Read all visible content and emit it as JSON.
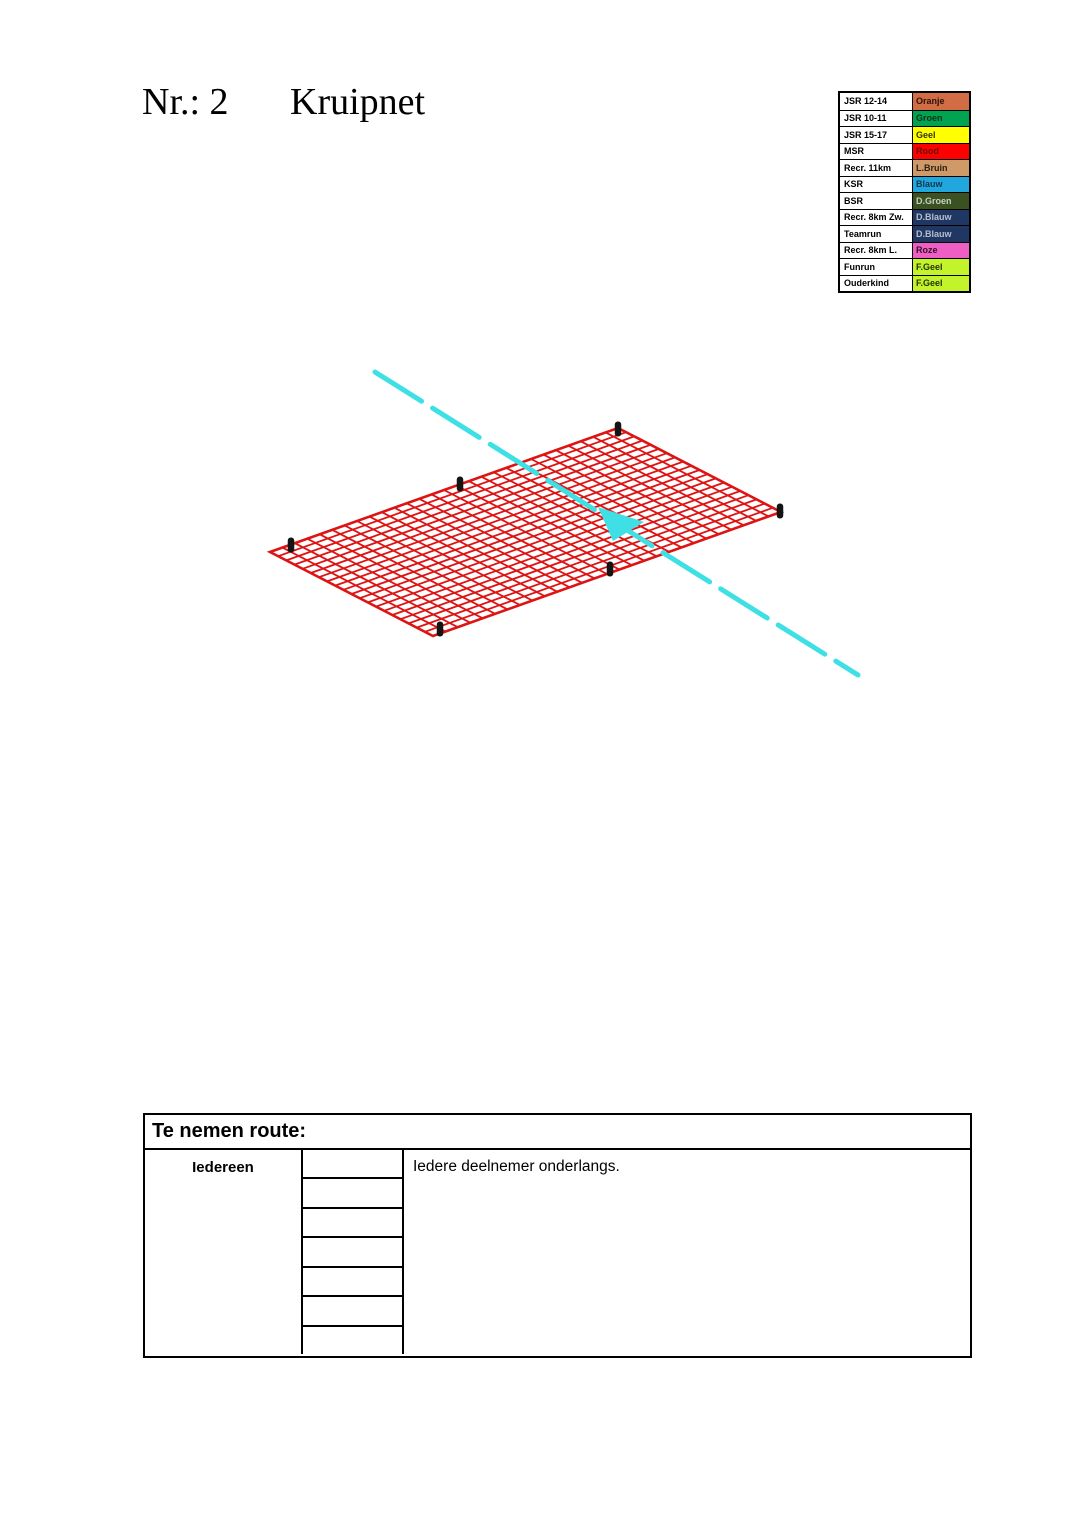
{
  "header": {
    "number_label": "Nr.: 2",
    "title": "Kruipnet"
  },
  "legend": {
    "rows": [
      {
        "label": "JSR 12-14",
        "color_name": "Oranje",
        "bg": "#D16C45",
        "fg": "#2A1209"
      },
      {
        "label": "JSR 10-11",
        "color_name": "Groen",
        "bg": "#00A350",
        "fg": "#13301C"
      },
      {
        "label": "JSR 15-17",
        "color_name": "Geel",
        "bg": "#FFFF00",
        "fg": "#33330A"
      },
      {
        "label": "MSR",
        "color_name": "Rood",
        "bg": "#FF0000",
        "fg": "#6B1007"
      },
      {
        "label": "Recr. 11km",
        "color_name": "L.Bruin",
        "bg": "#CF9A67",
        "fg": "#2E2013"
      },
      {
        "label": "KSR",
        "color_name": "Blauw",
        "bg": "#21A6DE",
        "fg": "#10374D"
      },
      {
        "label": "BSR",
        "color_name": "D.Groen",
        "bg": "#3A5222",
        "fg": "#C9CFC3"
      },
      {
        "label": "Recr. 8km Zw.",
        "color_name": "D.Blauw",
        "bg": "#203764",
        "fg": "#B9BFCA"
      },
      {
        "label": "Teamrun",
        "color_name": "D.Blauw",
        "bg": "#203764",
        "fg": "#B9BFCA"
      },
      {
        "label": "Recr. 8km L.",
        "color_name": "Roze",
        "bg": "#EF5EC2",
        "fg": "#331226"
      },
      {
        "label": "Funrun",
        "color_name": "F.Geel",
        "bg": "#C2F32B",
        "fg": "#28330A"
      },
      {
        "label": "Ouderkind",
        "color_name": "F.Geel",
        "bg": "#C2F32B",
        "fg": "#28330A"
      }
    ]
  },
  "diagram": {
    "description": "kruipnet-crawl-net-isometric",
    "net": {
      "corner_top": [
        618,
        428
      ],
      "corner_right": [
        781,
        512
      ],
      "corner_bottom": [
        433,
        636
      ],
      "corner_left": [
        270,
        552
      ],
      "divisions_long_edge": 28,
      "divisions_short_edge": 20,
      "grid_color": "#DE1313",
      "grid_stroke_width": 1.8,
      "outline_stroke_width": 2.6
    },
    "posts": {
      "color": "#141414",
      "width": 6.5,
      "height": 15,
      "positions": [
        [
          618,
          429
        ],
        [
          460,
          484
        ],
        [
          291,
          545
        ],
        [
          780,
          511
        ],
        [
          610,
          569
        ],
        [
          440,
          629
        ]
      ]
    },
    "arrow": {
      "color": "#3FE0E5",
      "from": [
        375,
        372
      ],
      "to": [
        858,
        675
      ],
      "stroke_width": 5,
      "dash": "55 13",
      "head_points": [
        [
          598,
          507
        ],
        [
          613,
          541
        ],
        [
          644,
          522
        ]
      ]
    }
  },
  "route": {
    "header": "Te nemen route:",
    "participant": "Iedereen",
    "description": "Iedere deelnemer onderlangs.",
    "empty_cell_count": 7
  }
}
